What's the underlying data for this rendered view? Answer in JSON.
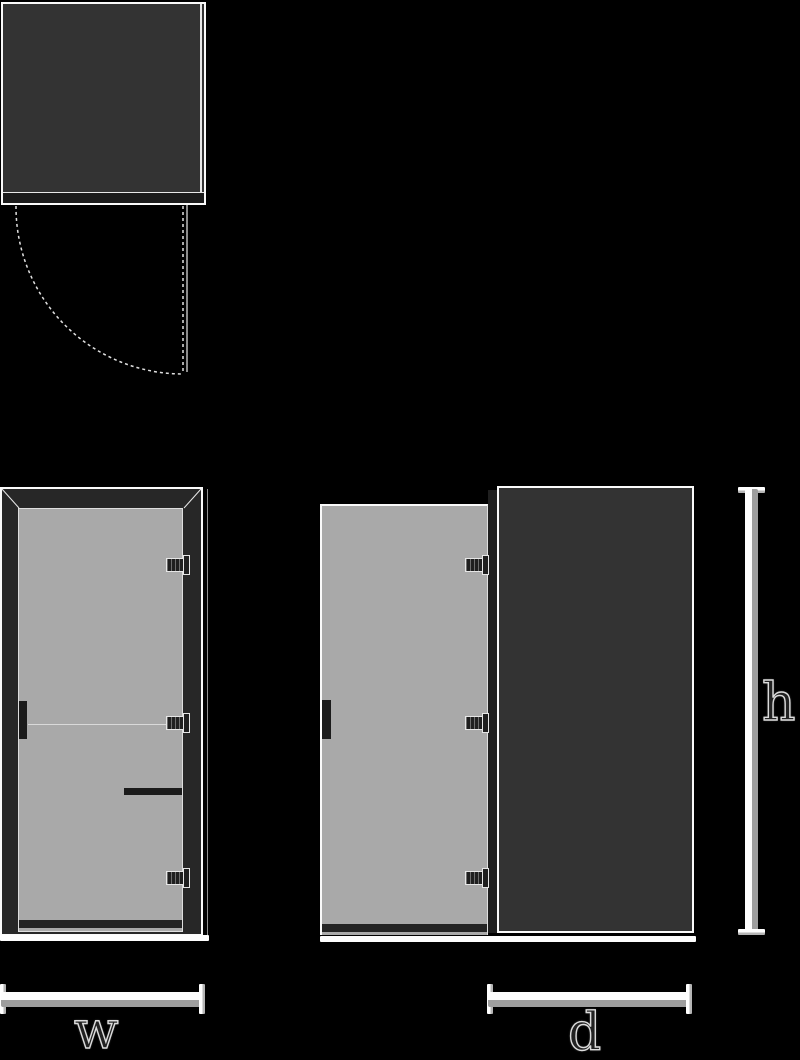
{
  "diagram": {
    "labels": {
      "width": "w",
      "depth": "d",
      "height": "h"
    },
    "icons": {
      "swing_arc": "door-swing-dashed-arc",
      "hinge": "hinge-icon",
      "handle": "handle-bar"
    },
    "colors": {
      "background": "#000000",
      "outline": "#fafafa",
      "panel_dark": "#333333",
      "frame_dark": "#272727",
      "glass": "#a9a9a9",
      "hardware_dark": "#1b1b1b",
      "hinge_dark": "#1f1f1f",
      "dimension_light": "#fdfdfd",
      "dimension_shade": "#9e9e9e",
      "label_fill": "#222222",
      "label_stroke": "#dcdcdc"
    }
  }
}
